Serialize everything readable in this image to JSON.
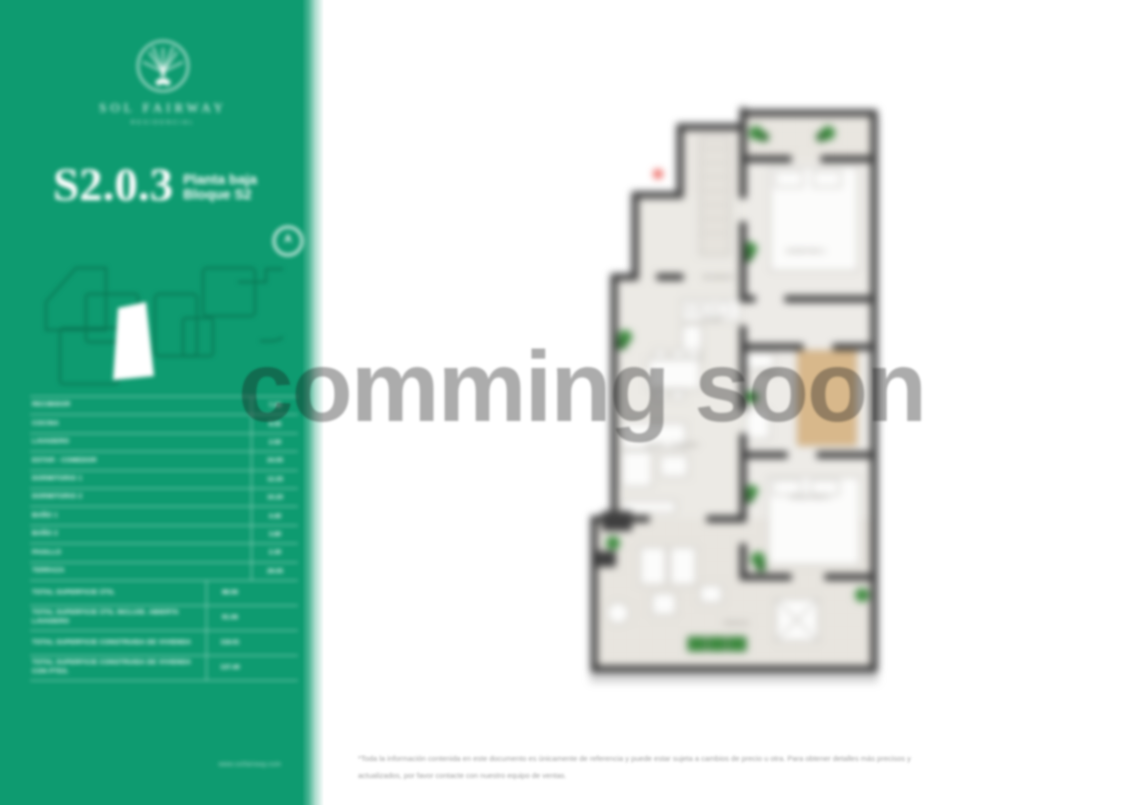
{
  "watermark": {
    "text": "comming soon",
    "color_overlay": "rgba(25,25,25,0.36)"
  },
  "sidebar": {
    "background_color": "#0e9b70",
    "logo": {
      "name": "SOL FAIRWAY",
      "subtitle": "RESIDENCIAL",
      "icon": "sun-palm-emblem"
    },
    "unit": {
      "code": "S2.0.3",
      "floor": "Planta baja",
      "block": "Bloque S2"
    },
    "table": {
      "rows": [
        {
          "label": "RECIBIDOR",
          "value": "7.35"
        },
        {
          "label": "COCINA",
          "value": "8.55"
        },
        {
          "label": "LAVADERO",
          "value": "2.50"
        },
        {
          "label": "ESTAR - COMEDOR",
          "value": "24.05"
        },
        {
          "label": "DORMITORIO 1",
          "value": "12.25"
        },
        {
          "label": "DORMITORIO 2",
          "value": "10.20"
        },
        {
          "label": "BAÑO 1",
          "value": "4.40"
        },
        {
          "label": "BAÑO 2",
          "value": "3.80"
        },
        {
          "label": "PASILLO",
          "value": "2.30"
        },
        {
          "label": "TERRAZA",
          "value": "29.05"
        }
      ],
      "totals": [
        {
          "label": "TOTAL SUPERFICIE ÚTIL",
          "value": "88.56"
        },
        {
          "label": "TOTAL SUPERFICIE ÚTIL INCLUID. ABIERTA LAVADERO",
          "value": "91.06"
        },
        {
          "label": "TOTAL SUPERFICIE CONSTRUIDA DE VIVIENDA",
          "value": "118.01"
        },
        {
          "label": "TOTAL SUPERFICIE CONSTRUIDA DE VIVIENDA CON PTES.",
          "value": "137.40"
        }
      ]
    },
    "footer_link": "www.solfairway.com"
  },
  "floorplan": {
    "marker_color": "#e8423b",
    "wall_color": "#3f3f3f",
    "labels": [
      "RECIBIDOR",
      "DORMITORIO 1",
      "COCINA",
      "ESTAR - COMEDOR",
      "BAÑO 1",
      "DORMITORIO 2",
      "TERRAZA"
    ]
  },
  "footer": {
    "line1": "*Toda la información contenida en este documento es únicamente de referencia y puede estar sujeta a cambios de precio u otra. Para obtener detalles más precisos y",
    "line2": "actualizados, por favor contacte con nuestro equipo de ventas."
  }
}
